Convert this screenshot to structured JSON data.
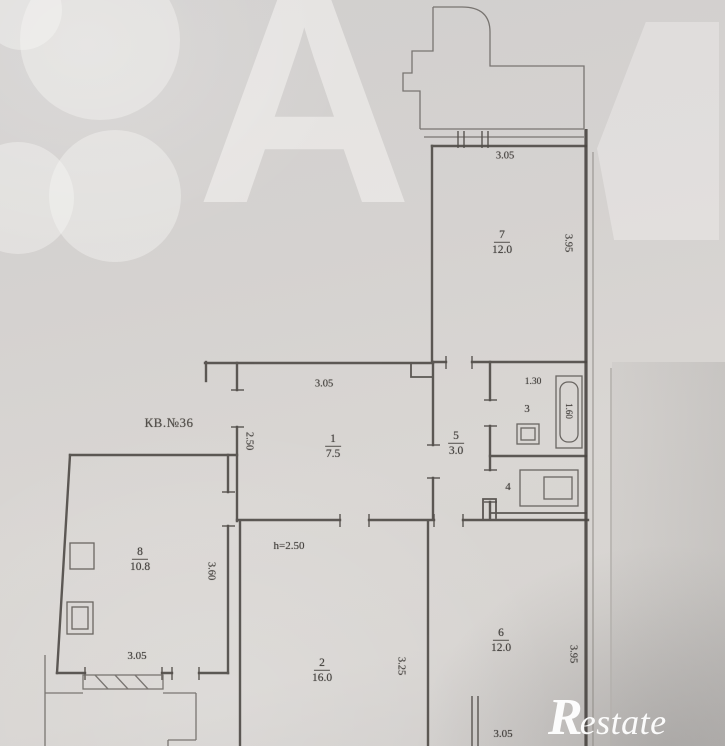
{
  "apartment": {
    "unit_label": "КВ.№36"
  },
  "rooms": {
    "hall": {
      "num": "1",
      "area": "7.5"
    },
    "living": {
      "num": "2",
      "area": "16.0"
    },
    "bath": {
      "num": "3"
    },
    "wc": {
      "num": "4"
    },
    "lobby": {
      "num": "5",
      "area": "3.0"
    },
    "bedroom": {
      "num": "6",
      "area": "12.0"
    },
    "upper_room": {
      "num": "7",
      "area": "12.0"
    },
    "kitchen": {
      "num": "8",
      "area": "10.8"
    }
  },
  "dimensions": {
    "upper_room_top": "3.05",
    "upper_room_side": "3.95",
    "hall_top": "3.05",
    "hall_side": "2.50",
    "bath_top": "1.30",
    "bath_tub": "1.60",
    "kitchen_side": "3.60",
    "kitchen_bottom": "3.05",
    "living_ceiling": "h=2.50",
    "living_side": "3.25",
    "bedroom_side": "3.95",
    "bedroom_bottom": "3.05"
  },
  "watermarks": {
    "letter": "А",
    "logo_r": "R",
    "logo_rest": "estate"
  },
  "colors": {
    "paper": "#d6d3d1",
    "ink": "#4e4a46",
    "watermark_white": "#f9f8f6"
  }
}
